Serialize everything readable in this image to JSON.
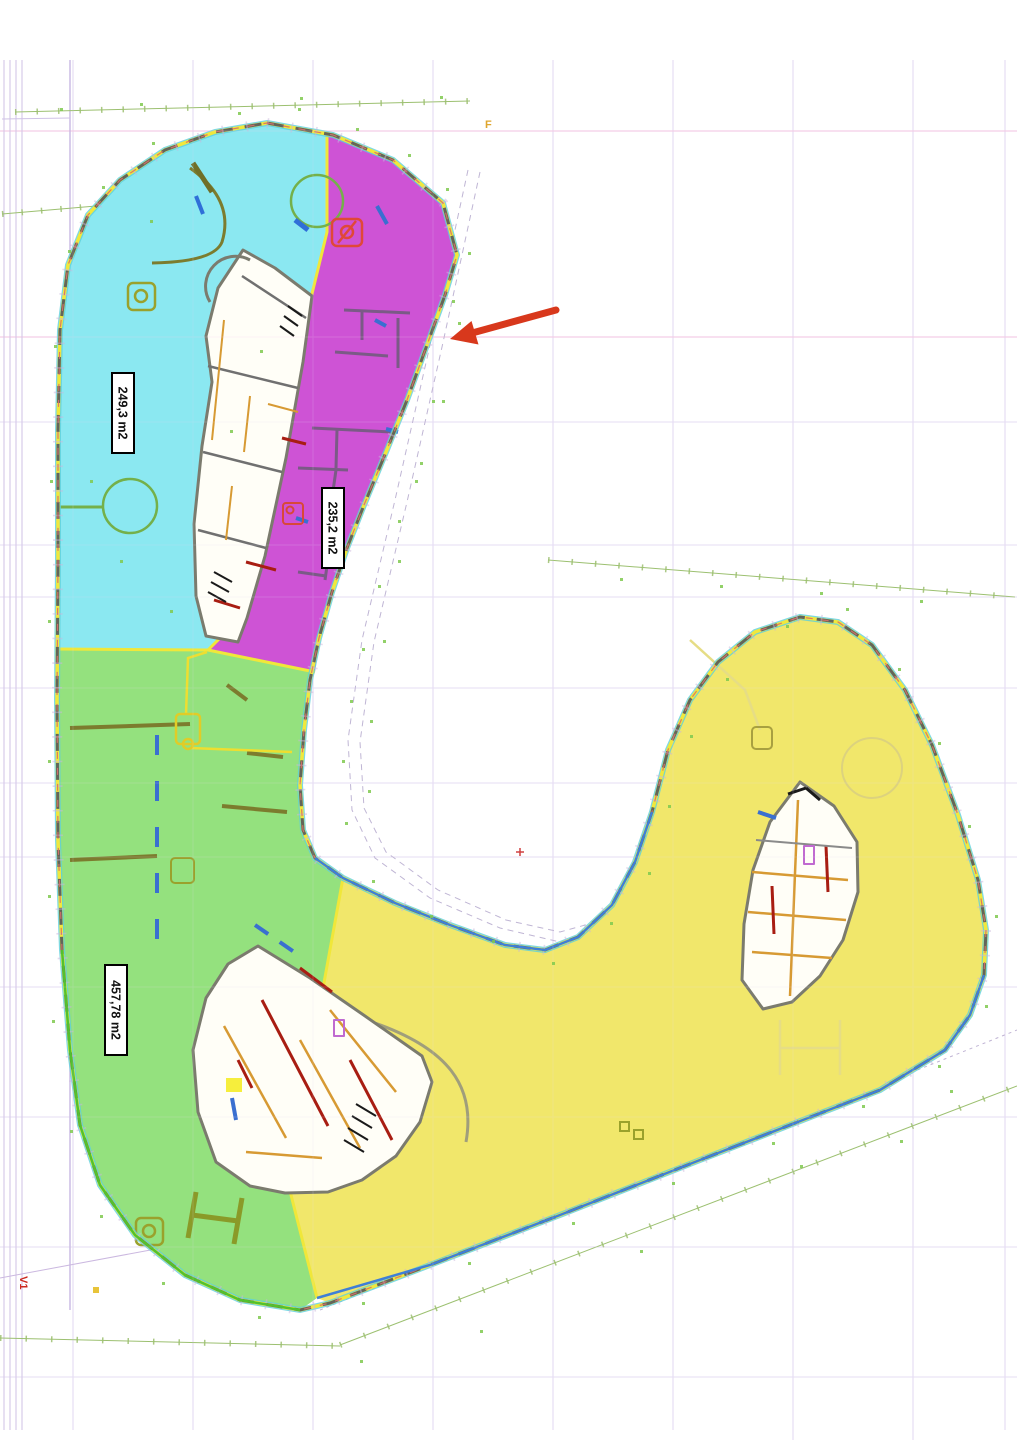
{
  "plan": {
    "zones": [
      {
        "id": "cyan",
        "area_label": "249,3 m2",
        "fill": "#8BE8F1"
      },
      {
        "id": "magenta",
        "area_label": "235,2 m2",
        "fill": "#CE53D5"
      },
      {
        "id": "green",
        "area_label": "457,78 m2",
        "fill": "#94E17E"
      },
      {
        "id": "yellow",
        "fill": "#F1E76B"
      }
    ],
    "markers": {
      "axis_marker": "V1",
      "grid_point": "F"
    },
    "arrow": {
      "color": "#D8381C"
    },
    "accents": {
      "zone_boundary": "#F0E73A",
      "facade_dash": "#63655A",
      "facade_blue": "#3F7FD6",
      "facade_green": "#52C22E"
    }
  }
}
